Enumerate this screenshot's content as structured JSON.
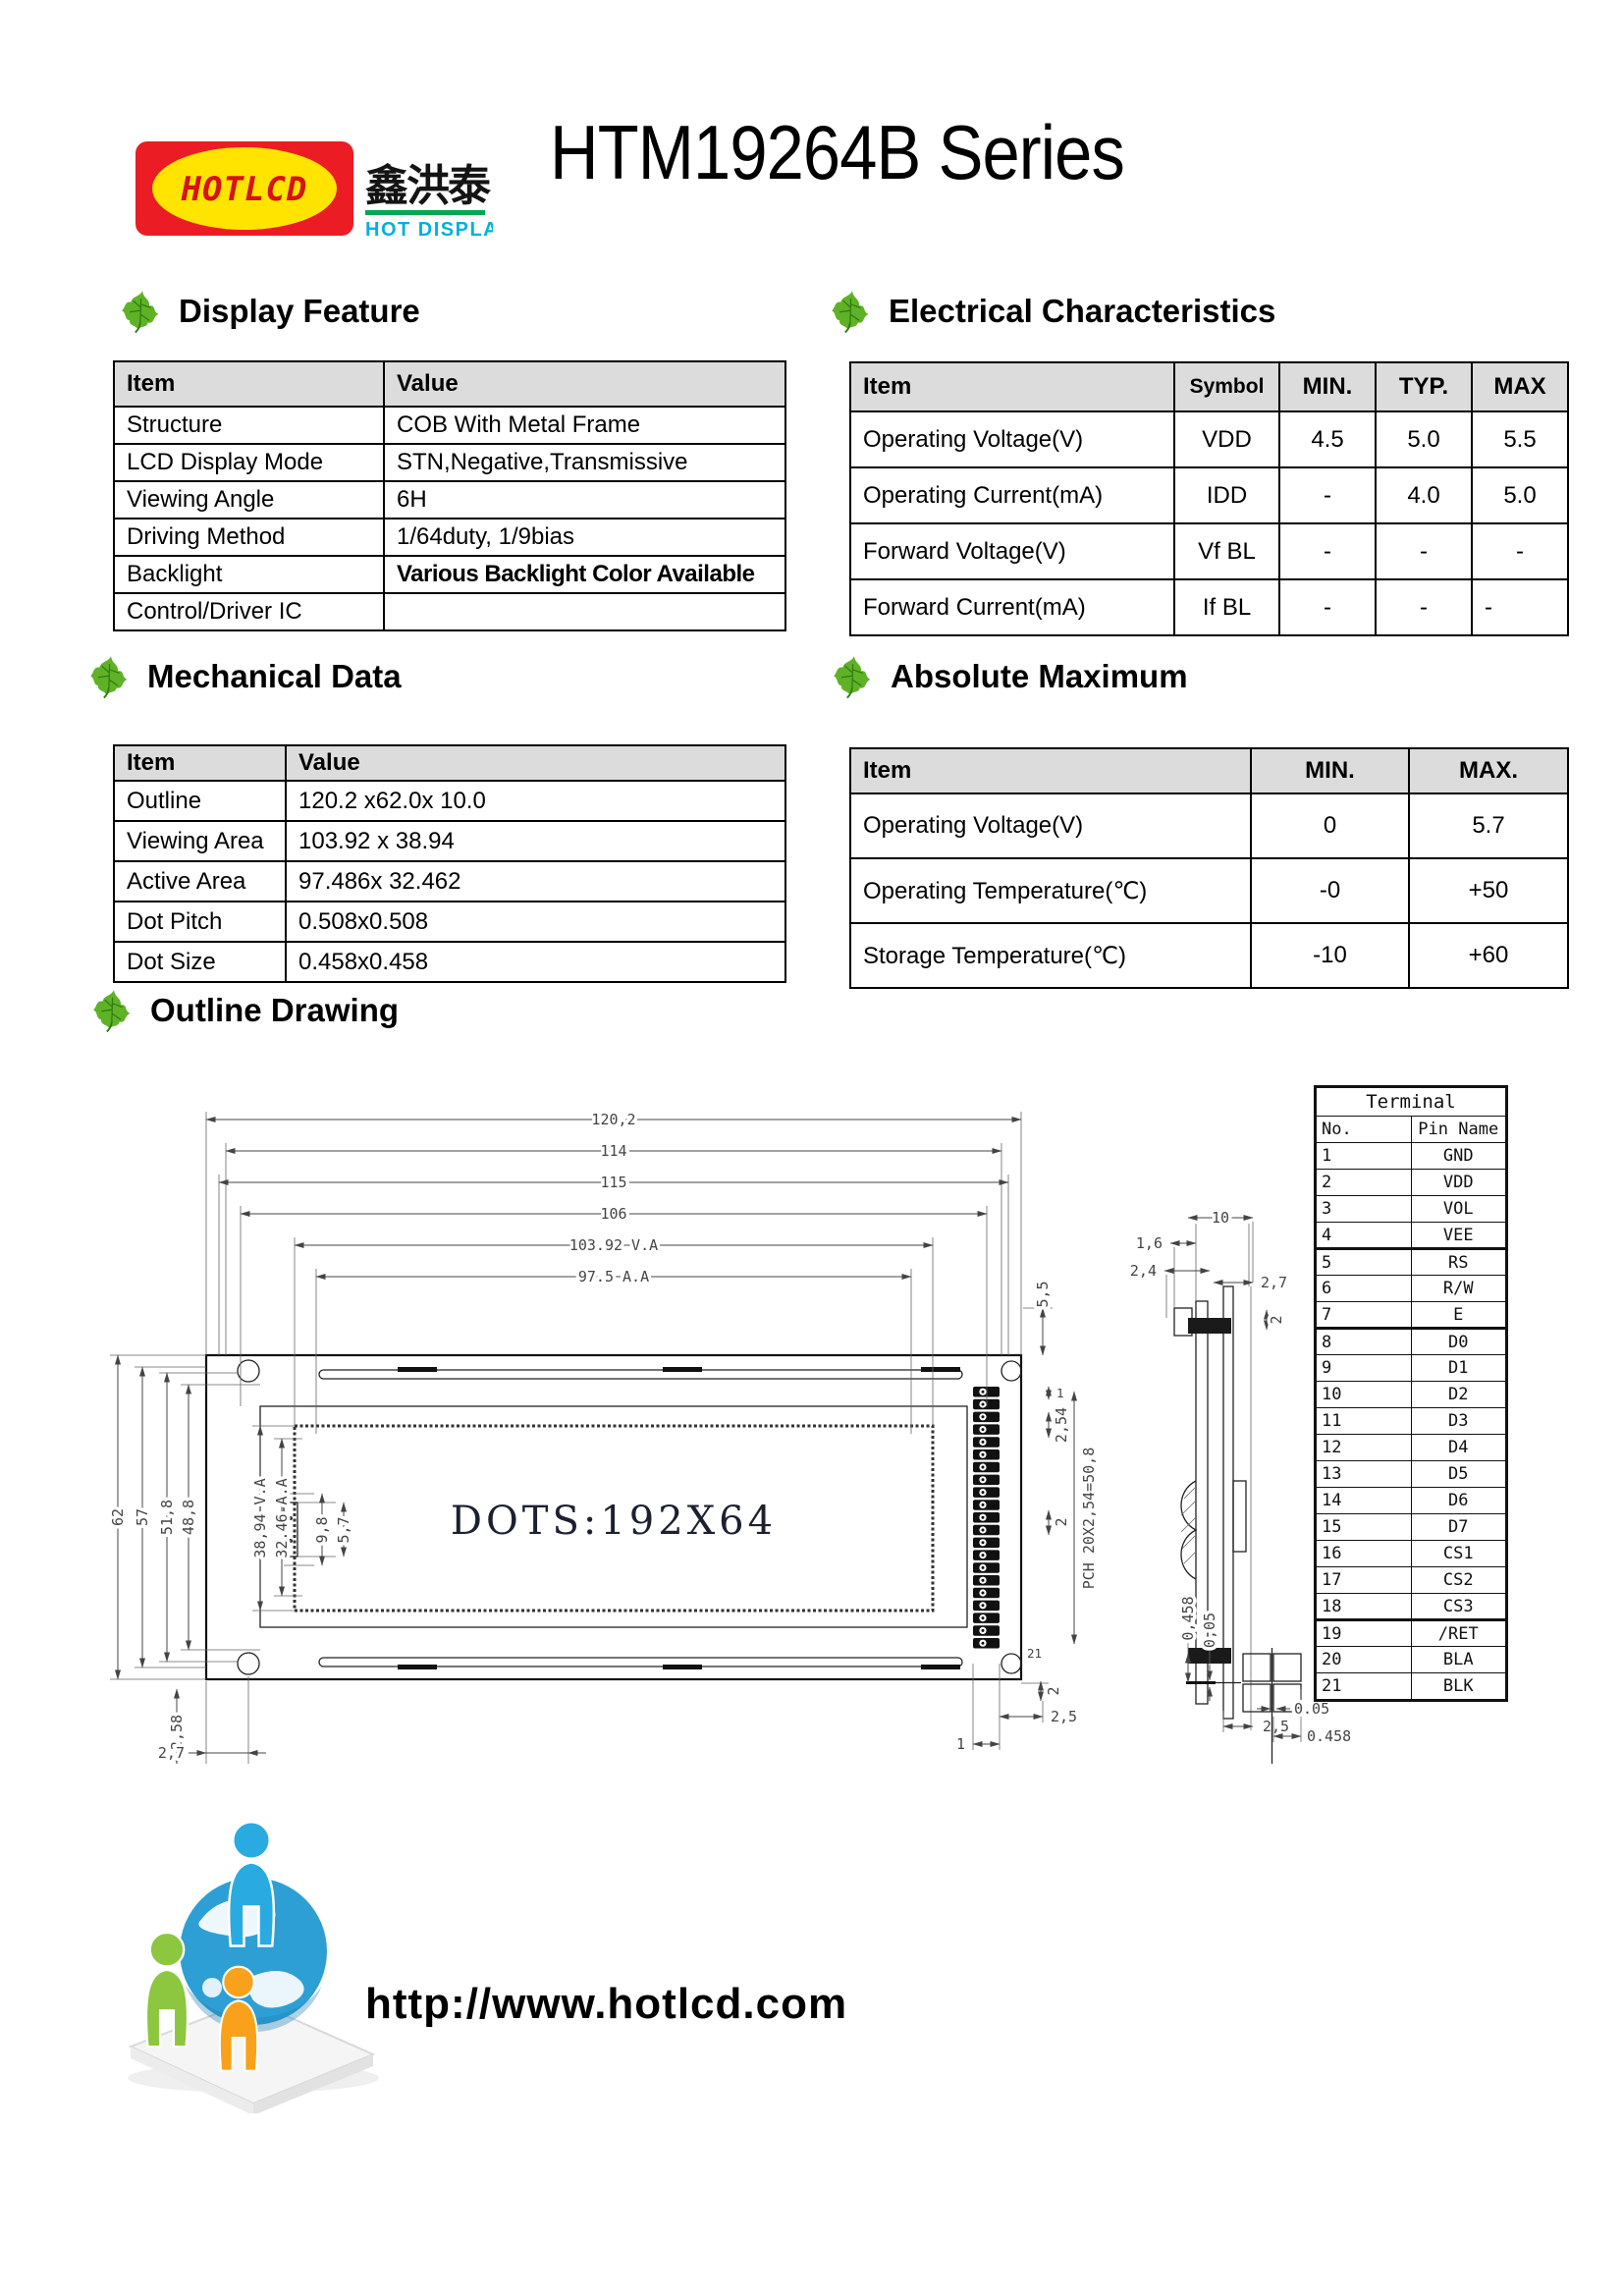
{
  "header": {
    "logo": {
      "mark": "HOTLCD",
      "cn": "鑫洪泰",
      "tagline": "HOT DISPLAY",
      "colors": {
        "red": "#ec1c24",
        "yellow": "#ffe400",
        "green_bar": "#00a651",
        "cyan": "#00b0df"
      }
    },
    "title": "HTM19264B Series"
  },
  "sections": {
    "display_feature": {
      "title": "Display Feature",
      "headers": [
        "Item",
        "Value"
      ],
      "rows": [
        [
          "Structure",
          "COB With Metal Frame"
        ],
        [
          "LCD Display Mode",
          "STN,Negative,Transmissive"
        ],
        [
          "Viewing Angle",
          "6H"
        ],
        [
          "Driving Method",
          "1/64duty, 1/9bias"
        ],
        [
          "Backlight",
          "Various Backlight Color Available"
        ],
        [
          "Control/Driver IC",
          ""
        ]
      ]
    },
    "electrical": {
      "title": "Electrical Characteristics",
      "headers": [
        "Item",
        "Symbol",
        "MIN.",
        "TYP.",
        "MAX"
      ],
      "rows": [
        [
          "Operating Voltage(V)",
          "VDD",
          "4.5",
          "5.0",
          "5.5"
        ],
        [
          "Operating Current(mA)",
          "IDD",
          "-",
          "4.0",
          "5.0"
        ],
        [
          "Forward Voltage(V)",
          "Vf BL",
          "-",
          "-",
          "-"
        ],
        [
          "Forward Current(mA)",
          "If BL",
          "-",
          "-",
          "-"
        ]
      ]
    },
    "mechanical": {
      "title": "Mechanical Data",
      "headers": [
        "Item",
        "Value"
      ],
      "rows": [
        [
          "Outline",
          "120.2 x62.0x 10.0"
        ],
        [
          "Viewing Area",
          "103.92 x 38.94"
        ],
        [
          "Active Area",
          "97.486x 32.462"
        ],
        [
          "Dot Pitch",
          "0.508x0.508"
        ],
        [
          "Dot Size",
          "0.458x0.458"
        ]
      ]
    },
    "absolute_maximum": {
      "title": "Absolute Maximum",
      "headers": [
        "Item",
        "MIN.",
        "MAX."
      ],
      "rows": [
        [
          "Operating Voltage(V)",
          "0",
          "5.7"
        ],
        [
          "Operating Temperature(℃)",
          "-0",
          "+50"
        ],
        [
          "Storage Temperature(℃)",
          "-10",
          "+60"
        ]
      ]
    },
    "outline": {
      "title": "Outline Drawing"
    }
  },
  "drawing": {
    "display_text": "DOTS:192X64",
    "h_dims": [
      "120,2",
      "114",
      "115",
      "106",
      "103.92 V.A",
      "97.5 A.A"
    ],
    "v_dims": [
      "62",
      "57",
      "51,8",
      "48,8",
      "38,94 V.A",
      "32.46 A.A",
      "9,8",
      "5,7"
    ],
    "bottom_left_dims": [
      "2,58",
      "2,7"
    ],
    "right_dims": {
      "top_gap": "5,5",
      "pin_top": "1",
      "pitch": "2,54",
      "pad": "2",
      "pch": "PCH 20X2,54=50,8",
      "last_pin": "21",
      "bottom_v": "2",
      "bottom_h": "2,5",
      "bottom_offset": "1"
    },
    "side_dims": {
      "width": "10",
      "t1": "1,6",
      "t2": "2,4",
      "t3": "2,7",
      "t4": "2",
      "bottom": "2,5"
    },
    "dot_dims": {
      "v1": "0,458",
      "v2": "0,05",
      "h1": "0.05",
      "h2": "0.458"
    }
  },
  "terminal": {
    "title": "Terminal",
    "headers": [
      "No.",
      "Pin Name"
    ],
    "pins": [
      [
        "1",
        "GND"
      ],
      [
        "2",
        "VDD"
      ],
      [
        "3",
        "VOL"
      ],
      [
        "4",
        "VEE"
      ],
      [
        "5",
        "RS"
      ],
      [
        "6",
        "R/W"
      ],
      [
        "7",
        "E"
      ],
      [
        "8",
        "D0"
      ],
      [
        "9",
        "D1"
      ],
      [
        "10",
        "D2"
      ],
      [
        "11",
        "D3"
      ],
      [
        "12",
        "D4"
      ],
      [
        "13",
        "D5"
      ],
      [
        "14",
        "D6"
      ],
      [
        "15",
        "D7"
      ],
      [
        "16",
        "CS1"
      ],
      [
        "17",
        "CS2"
      ],
      [
        "18",
        "CS3"
      ],
      [
        "19",
        "/RET"
      ],
      [
        "20",
        "BLA"
      ],
      [
        "21",
        "BLK"
      ]
    ]
  },
  "footer": {
    "url": "http://www.hotlcd.com"
  }
}
